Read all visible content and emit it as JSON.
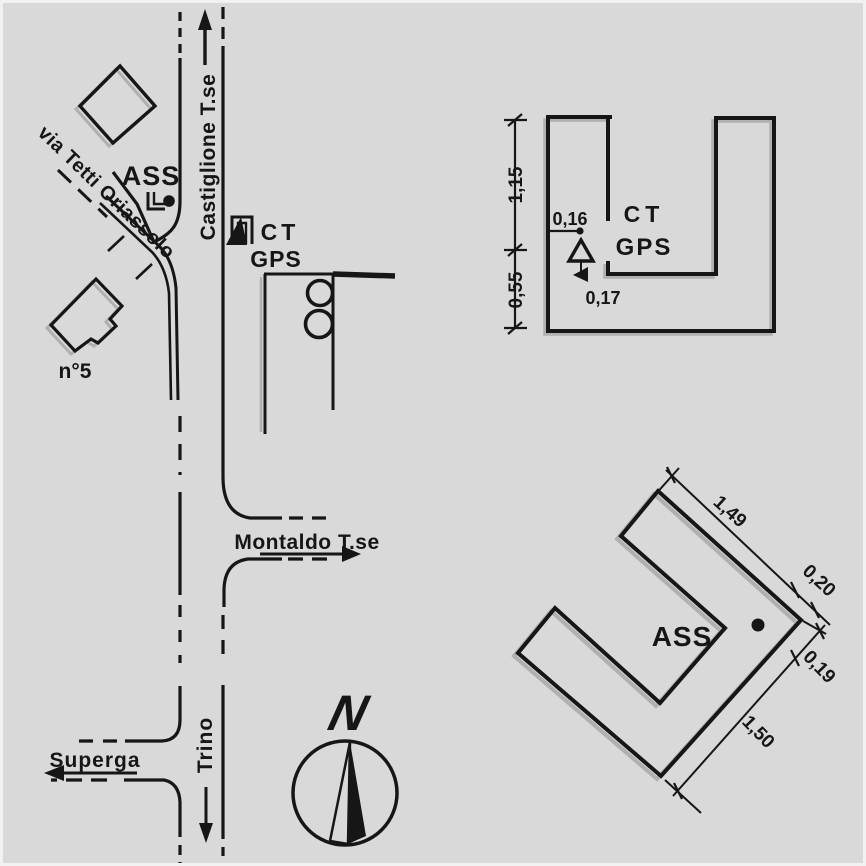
{
  "colors": {
    "paper": "#d9d9d9",
    "ink": "#161616",
    "shadow": "#b0b0b0"
  },
  "map": {
    "streets": {
      "castiglione": "Castiglione T.se",
      "via_tetti": "via Tetti Oriassolo",
      "montaldo": "Montaldo T.se",
      "superga": "Superga",
      "trino": "Trino"
    },
    "labels": {
      "ass": "ASS",
      "ct": "CT",
      "gps": "GPS",
      "house_number": "n°5"
    },
    "compass": {
      "north": "N"
    }
  },
  "detail_top": {
    "labels": {
      "ct": "CT",
      "gps": "GPS"
    },
    "dims": {
      "d115": "1,15",
      "d055": "0,55",
      "d016": "0,16",
      "d017": "0,17"
    }
  },
  "detail_bottom": {
    "labels": {
      "ass": "ASS"
    },
    "dims": {
      "d149": "1,49",
      "d020": "0,20",
      "d019": "0,19",
      "d150": "1,50"
    }
  }
}
